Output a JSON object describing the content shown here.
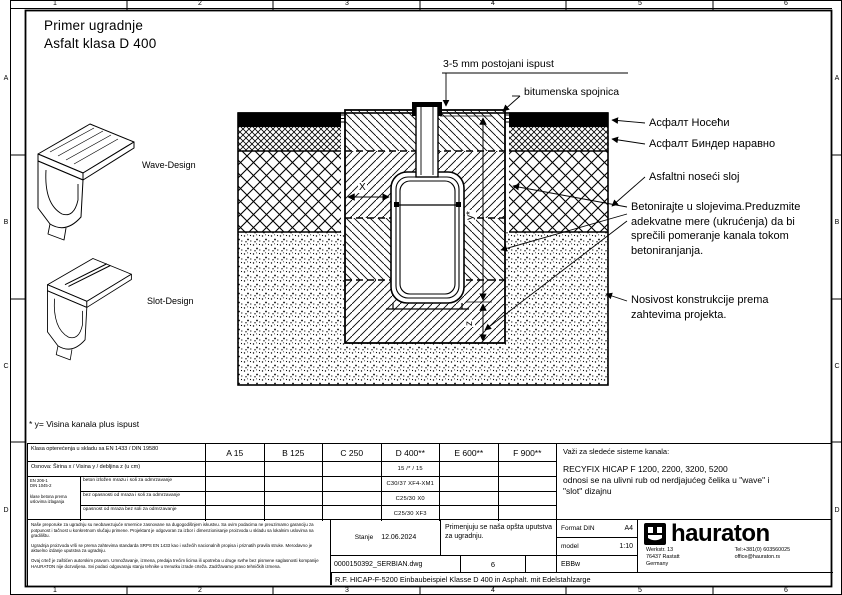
{
  "page": {
    "title_line1": "Primer ugradnje",
    "title_line2": "Asfalt klasa D 400"
  },
  "frame": {
    "cols": [
      "1",
      "2",
      "3",
      "4",
      "5",
      "6"
    ],
    "rows": [
      "A",
      "B",
      "C",
      "D"
    ]
  },
  "designs": {
    "wave_label": "Wave-Design",
    "slot_label": "Slot-Design"
  },
  "diagram": {
    "dim_x": "X",
    "dim_y": "y*",
    "dim_z": "z",
    "callout_ispust": "3-5 mm postojani ispust",
    "callout_spojnica": "bitumenska spojnica",
    "layer_noseci": "Асфалт Носећи",
    "layer_binder": "Асфалт Биндер наравно",
    "layer_asfaltni": "Asfaltni noseći sloj",
    "note_beton": "Betonirajte u slojevima.Preduzmite adekvatne mere (ukrućenja) da bi sprečili pomeranje kanala tokom betoniranjanja.",
    "note_nosivost": "Nosivost konstrukcije prema zahtevima projekta."
  },
  "footnote": "* y= Visina kanala plus ispust",
  "table": {
    "load_class_label": "Klasa opterećenja u skladu sa EN 1433 / DIN 19580",
    "classes": [
      "A 15",
      "B 125",
      "C 250",
      "D 400**",
      "E 600**",
      "F 900**"
    ],
    "dimension_label": "Osnova: Širina x / Visina y / debljina z (u cm)",
    "dimension_d400": "15 /* / 15",
    "concrete_note": "EN 206-1\nDIN 1045-2\n\nklase betona prema\nuslovima izlaganja",
    "rows": [
      {
        "label": "beton izložen mrazu i soli za odmrzavanje",
        "d400": "C30/37 XF4-XM1"
      },
      {
        "label": "bez opasnosti od mraza i soli za odmrzavanje",
        "d400": "C25/30 X0"
      },
      {
        "label": "opasnost od mraza bez soli za odmrzavanje",
        "d400": "C25/30 XF3"
      }
    ],
    "systems_title": "Važi za sledeće sisteme kanala:",
    "systems_line1": "RECYFIX HICAP F 1200, 2200, 3200, 5200",
    "systems_line2": "odnosi se na ulivni rub od nerdjajućeg čelika u \"wave\" i",
    "systems_line3": "\"slot\" dizajnu"
  },
  "titleblock": {
    "disclaimer1": "Naše preporuke za ugradnju su neobavezujuće smernice zasnovane na dugogodišnjem iskustvu. Sa ovim podacima ne preuzimamo garanciju za potpunost i tačnost u konkretnom slučaju primene. Projektant je odgovoran za izbor i dimenzionisanje proizvoda u skladu sa lokalnim uslovima na gradilištu.",
    "disclaimer2": "Ugradnja proizvoda vrši se prema zahtevima standarda SRPS EN 1433 kao i važećih nacionalnih propisa i priznatih pravila struke. Merodavno je aktuelno izdanje uputstva za ugradnju.",
    "disclaimer3": "Ovaj crtež je zaštićen autorskim pravom. Umnožavanje, izmena, predaja trećim licima ili upotreba u druge svrhe bez pismene saglasnosti kompanije HAURATON nije dozvoljena. Svi podaci odgovaraju stanju tehnike u trenutku izrade crteža. Zadržavamo pravo tehničkih izmena.",
    "stanje_label": "Stanje",
    "stanje_date": "12.06.2024",
    "note": "Primenjuju se naša opšta uputstva za ugradnju.",
    "format_label": "Format DIN",
    "format_value": "A4",
    "model_label": "model",
    "model_value": "1:10",
    "code": "EBBw",
    "file_name": "0000150392_SERBIAN.dwg",
    "revision": "6",
    "doc_title": "R.F. HICAP-F-5200 Einbaubeispiel Klasse D 400 in Asphalt. mit Edelstahlzarge",
    "brand": "hauraton",
    "address_line1": "Werkstr. 13",
    "address_line2": "76437 Rastatt",
    "address_line3": "Germany",
    "phone": "Tel:+381(0) 603560025",
    "email": "office@hauraton.rs"
  }
}
